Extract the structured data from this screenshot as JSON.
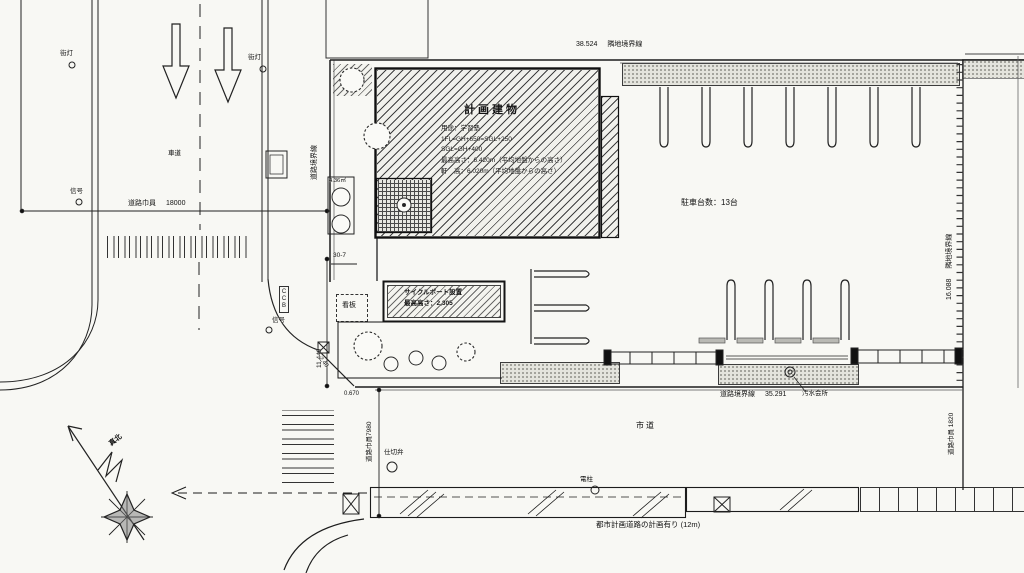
{
  "colors": {
    "paper": "#f8f8f4",
    "ink": "#1a1a1a",
    "planting_gray": "#e4e4dd"
  },
  "boundaries": {
    "top": {
      "dim": "38.524",
      "label": "隣地境界線"
    },
    "right": {
      "dim": "16.088",
      "label": "隣地境界線"
    },
    "left": {
      "label": "道路境界線"
    },
    "south": {
      "label": "道路境界線",
      "dim": "35.291"
    }
  },
  "building": {
    "title": "計画建物",
    "lines": [
      "用途：学習塾",
      "1FL=GH+650=SGL+250",
      "SGL=GH+400",
      "最高高さ：6.420m（平均地盤からの高さ）",
      "軒　高：6.020m（平均地盤からの高さ）"
    ]
  },
  "site": {
    "parking_count": "駐車台数：13台",
    "cycle_port_line1": "サイクルポート設置",
    "cycle_port_line2": "最高高さ：2,305",
    "signboard": "看板",
    "ccb": "CCB",
    "area_436": "4.36㎡"
  },
  "roads": {
    "west_width_label": "道路巾員",
    "west_width_value": "18000",
    "roadway": "車道",
    "south_width": "道路巾員7980",
    "east_width": "道路巾員 1820",
    "city_road": "市道",
    "planned_road": "都市計画道路の計画有り (12m)"
  },
  "features": {
    "streetlight1": "街灯",
    "streetlight2": "街灯",
    "signal1": "信号",
    "signal2": "信号",
    "gate_valve": "仕切弁",
    "utility_pole": "電柱",
    "sewage": "汚水会所",
    "true_north": "真北"
  },
  "dims": {
    "d11449": "11.449",
    "d30_7": "30-7",
    "d240": "2.40",
    "d0670": "0.670"
  }
}
